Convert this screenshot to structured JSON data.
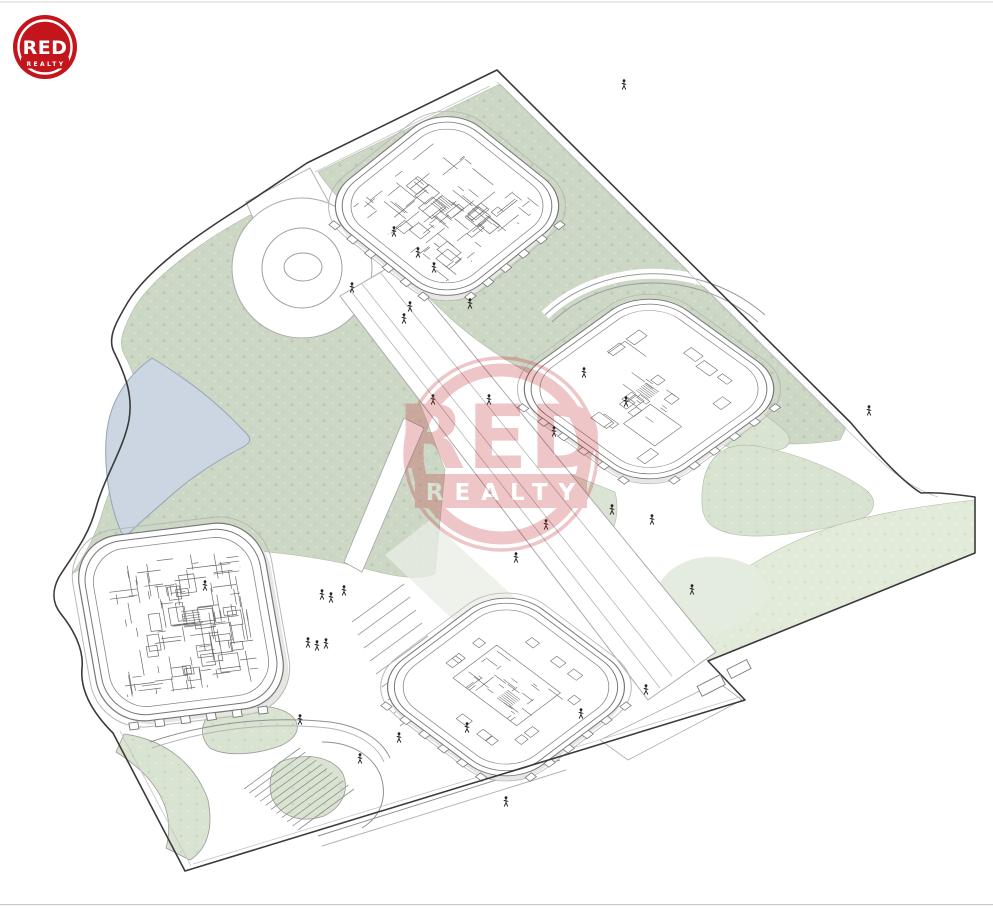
{
  "brand": {
    "name": "RED",
    "sub": "REALTY",
    "red": "#c3161c"
  },
  "watermark": {
    "name": "RED",
    "sub": "REALTY",
    "color": "#c0262c",
    "opacity": "0.26"
  },
  "scene": {
    "kind": "axonometric-architectural-site-plan",
    "site_elements": [
      "site-boundary",
      "lawn-northwest",
      "lawn-north",
      "pond",
      "roundabout",
      "main-boulevard",
      "footpaths",
      "central-plaza",
      "terraced-garden",
      "garden-stairs",
      "amphitheater-steps",
      "boundary-gates"
    ],
    "buildings": [
      {
        "name": "building-north",
        "shape": "rounded-square",
        "interior": "dense-room-partitions-with-stair"
      },
      {
        "name": "building-east",
        "shape": "rounded-square",
        "interior": "open-floor-central-core"
      },
      {
        "name": "building-west",
        "shape": "rounded-square",
        "interior": "dense-room-partitions"
      },
      {
        "name": "building-south",
        "shape": "rounded-square",
        "interior": "central-core-cluster"
      }
    ],
    "colors": {
      "lawn": "#ccd7c5",
      "lawn_light": "#d9e3d1",
      "lawn_strip": "#e2ead9",
      "lawn_pale": "#e4ebdf",
      "pond": "#cbd6e2",
      "pond_edge": "#94a3b6",
      "outline": "#3a3a3a",
      "path_line": "#ababab",
      "wall_line": "#8f8f8f",
      "building_line": "#6b6b6b",
      "people": "#222222"
    }
  }
}
